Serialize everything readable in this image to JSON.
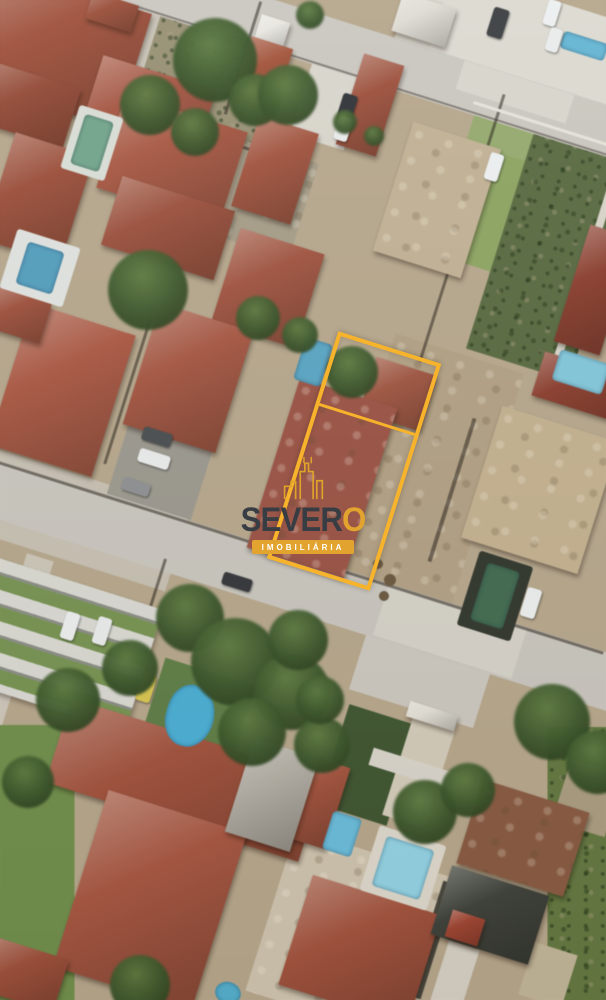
{
  "watermark": {
    "brand_full": "SEVERO",
    "brand_prefix": "SEVER",
    "brand_accent": "O",
    "tagline": "IMOBILIÁRIA",
    "brand_text_color": "#383D44",
    "accent_gold": "#E2A42E"
  },
  "lot_outline": {
    "color": "#F7B32B",
    "shape": "rotated-rectangle"
  },
  "palette": {
    "ground_sand": "#B6A78D",
    "road_gray": "#CAC7C0",
    "roof_terracotta": "#A65139",
    "roof_tan": "#C4B18E",
    "roof_maroon": "#8D3C2C",
    "pool_blue": "#57A8C8",
    "pool_teal": "#6FA58A",
    "pool_dark_green": "#3F6B4F",
    "grass_green": "#6D8C4B",
    "tree_green": "#3A5729",
    "car_yellow": "#D8C64A"
  }
}
